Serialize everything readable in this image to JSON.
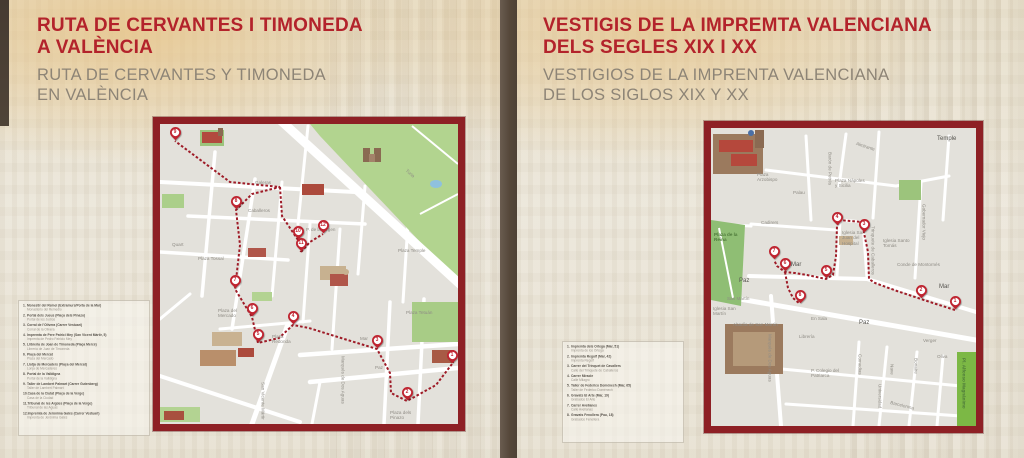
{
  "colors": {
    "title_red": "#b3232b",
    "subtitle_gray": "#8d8476",
    "map_border_red": "#8e2025",
    "route_red": "#9e1b27",
    "pin_red": "#bf2430",
    "divider_brown": "#544739",
    "background_beige": "#e7e1d2"
  },
  "left_panel": {
    "title_line1": "RUTA DE CERVANTES I TIMONEDA",
    "title_line2": "A VALÈNCIA",
    "subtitle_line1": "RUTA DE CERVANTES Y TIMONEDA",
    "subtitle_line2": "EN VALÈNCIA",
    "legend": [
      {
        "n": "1.",
        "ca": "Monestir del Remei (Extramurs/Porta de la Mar)",
        "es": "Monasterio del Remedio"
      },
      {
        "n": "2.",
        "ca": "Portal dels Jueus (Plaça dels Pinazo)",
        "es": "Portal de los Judíos"
      },
      {
        "n": "3.",
        "ca": "Corral de l'Olivera (Carrer Vestuari)",
        "es": "Corral de la Olivera"
      },
      {
        "n": "4.",
        "ca": "Impremta de Pere Patrici Mey (San Vicent Màrtir, 5)",
        "es": "Imprenta de Pedro Patricio Mey"
      },
      {
        "n": "5.",
        "ca": "Llibreria de Joan de Timoneda (Plaça Mercé)",
        "es": "Librería de Juan de Timoneda"
      },
      {
        "n": "6.",
        "ca": "Plaça del Mercat",
        "es": "Plaza del Mercado"
      },
      {
        "n": "7.",
        "ca": "Llotja de Mercaders (Plaça del Mercat)",
        "es": "Lonja de Mercaderes"
      },
      {
        "n": "8.",
        "ca": "Portal de la Valldigna",
        "es": "Portal de la Valldigna"
      },
      {
        "n": "9.",
        "ca": "Taller de Lambert Palmart (Carrer Gutenberg)",
        "es": "Taller de Lambert Palmart"
      },
      {
        "n": "10.",
        "ca": "Casa de la Ciutat (Plaça de la Verge)",
        "es": "Casa de la Ciudad"
      },
      {
        "n": "11.",
        "ca": "Tribunal de les Aigües (Plaça de la Verge)",
        "es": "Tribunal de las Aguas"
      },
      {
        "n": "12.",
        "ca": "Impremta de Jerònima Galés (Carrer Vestuari)",
        "es": "Imprenta de Jerónima Galés"
      }
    ],
    "map": {
      "pins": [
        {
          "n": "1",
          "x": 292,
          "y": 240
        },
        {
          "n": "2",
          "x": 247,
          "y": 277
        },
        {
          "n": "3",
          "x": 217,
          "y": 225
        },
        {
          "n": "4",
          "x": 133,
          "y": 201
        },
        {
          "n": "5",
          "x": 98,
          "y": 219
        },
        {
          "n": "6",
          "x": 92,
          "y": 193
        },
        {
          "n": "7",
          "x": 75,
          "y": 165
        },
        {
          "n": "8",
          "x": 76,
          "y": 86
        },
        {
          "n": "9",
          "x": 15,
          "y": 17
        },
        {
          "n": "10",
          "x": 138,
          "y": 116
        },
        {
          "n": "11",
          "x": 141,
          "y": 128
        },
        {
          "n": "12",
          "x": 163,
          "y": 110
        }
      ],
      "labels": [
        {
          "t": "Galeras",
          "x": 95,
          "y": 56
        },
        {
          "t": "Caballeros",
          "x": 88,
          "y": 84
        },
        {
          "t": "Quart",
          "x": 12,
          "y": 118
        },
        {
          "t": "Plaza Tossal",
          "x": 38,
          "y": 132,
          "cls": "wrap"
        },
        {
          "t": "Plaza del Mercado",
          "x": 58,
          "y": 184,
          "cls": "wrap"
        },
        {
          "t": "Plaza Redonda",
          "x": 112,
          "y": 210,
          "cls": "wrap"
        },
        {
          "t": "P. de la Virgen",
          "x": 146,
          "y": 103
        },
        {
          "t": "Mar",
          "x": 200,
          "y": 212
        },
        {
          "t": "Paz",
          "x": 215,
          "y": 241
        },
        {
          "t": "Plaza Tetuán",
          "x": 246,
          "y": 186,
          "cls": "wrap"
        },
        {
          "t": "Plaza Temple",
          "x": 238,
          "y": 124,
          "cls": "wrap"
        },
        {
          "t": "San Vicente Mártir",
          "x": 100,
          "y": 258,
          "cls": "vert"
        },
        {
          "t": "Marqués de Dos Aguas",
          "x": 180,
          "y": 232,
          "cls": "vert"
        },
        {
          "t": "Turia",
          "x": 248,
          "y": 44,
          "rot": 42
        },
        {
          "t": "Plaza dels Pinazo",
          "x": 230,
          "y": 286,
          "cls": "wrap"
        }
      ]
    }
  },
  "right_panel": {
    "title_line1": "VESTIGIS DE LA IMPREMTA VALENCIANA",
    "title_line2": "DELS SEGLES XIX I XX",
    "subtitle_line1": "VESTIGIOS DE LA IMPRENTA VALENCIANA",
    "subtitle_line2": "DE LOS SIGLOS XIX Y XX",
    "legend": [
      {
        "n": "1.",
        "ca": "Impremta dels Ortega (Mar, 51)",
        "es": "Imprenta de los Ortega"
      },
      {
        "n": "2.",
        "ca": "Impremta Regolf (Mar, 42)",
        "es": "Imprenta Regolf"
      },
      {
        "n": "3.",
        "ca": "Carrer del Trinquet de Cavallers",
        "es": "Calle del Trinquete de Caballeros"
      },
      {
        "n": "4.",
        "ca": "Carrer Miracle",
        "es": "Calle Milagro"
      },
      {
        "n": "5.",
        "ca": "Taller de Federico Doménech (Mar, 65)",
        "es": "Taller de Federico Doménech"
      },
      {
        "n": "6.",
        "ca": "Gravats El Arte (Mar, 19)",
        "es": "Grabados El Arte"
      },
      {
        "n": "7.",
        "ca": "Carrer Avellanes",
        "es": "Calle Avellanas"
      },
      {
        "n": "8.",
        "ca": "Gravats Fenollera (Pau, 18)",
        "es": "Grabados Fenollera"
      }
    ],
    "map": {
      "pins": [
        {
          "n": "1",
          "x": 244,
          "y": 182
        },
        {
          "n": "2",
          "x": 210,
          "y": 171
        },
        {
          "n": "3",
          "x": 153,
          "y": 105
        },
        {
          "n": "4",
          "x": 126,
          "y": 98
        },
        {
          "n": "5",
          "x": 115,
          "y": 151
        },
        {
          "n": "6",
          "x": 74,
          "y": 144
        },
        {
          "n": "7",
          "x": 63,
          "y": 132
        },
        {
          "n": "8",
          "x": 89,
          "y": 176
        }
      ],
      "labels": [
        {
          "t": "Temple",
          "x": 226,
          "y": 8,
          "cls": "lg"
        },
        {
          "t": "Plaza Arzobispo",
          "x": 46,
          "y": 44,
          "cls": "wrap"
        },
        {
          "t": "Palau",
          "x": 82,
          "y": 62
        },
        {
          "t": "Plaza Nápoles y Sicilia",
          "x": 124,
          "y": 50,
          "cls": "wrap"
        },
        {
          "t": "Almirante",
          "x": 146,
          "y": 13,
          "rot": 18
        },
        {
          "t": "Barón de Petrés",
          "x": 116,
          "y": 24,
          "cls": "vert"
        },
        {
          "t": "Gobernador Viejo",
          "x": 210,
          "y": 76,
          "cls": "vert"
        },
        {
          "t": "Cadirers",
          "x": 50,
          "y": 92
        },
        {
          "t": "Plaza de la Reina",
          "x": 3,
          "y": 104,
          "cls": "wrap plaza"
        },
        {
          "t": "Iglesia San Juan del Hospital",
          "x": 131,
          "y": 102,
          "cls": "wrap"
        },
        {
          "t": "Iglesia Santo Tomás",
          "x": 172,
          "y": 110,
          "cls": "wrap"
        },
        {
          "t": "Trinquete de Caballeros",
          "x": 159,
          "y": 98,
          "cls": "vert"
        },
        {
          "t": "Conde de Montornés",
          "x": 186,
          "y": 134
        },
        {
          "t": "Mar",
          "x": 80,
          "y": 134,
          "cls": "lg"
        },
        {
          "t": "Mar",
          "x": 228,
          "y": 156,
          "cls": "lg"
        },
        {
          "t": "Paz",
          "x": 28,
          "y": 150,
          "cls": "lg"
        },
        {
          "t": "Paz",
          "x": 148,
          "y": 192,
          "cls": "lg"
        },
        {
          "t": "San Martín",
          "x": 16,
          "y": 168
        },
        {
          "t": "Iglesia San Martín",
          "x": 2,
          "y": 178,
          "cls": "wrap"
        },
        {
          "t": "Abadía de San Martín",
          "x": 22,
          "y": 194
        },
        {
          "t": "Marqués de Dos Aguas",
          "x": 56,
          "y": 206,
          "cls": "vert"
        },
        {
          "t": "Librería",
          "x": 88,
          "y": 206
        },
        {
          "t": "En Sala",
          "x": 100,
          "y": 188
        },
        {
          "t": "Comedias",
          "x": 146,
          "y": 226,
          "cls": "vert"
        },
        {
          "t": "Universidad",
          "x": 166,
          "y": 256,
          "cls": "vert"
        },
        {
          "t": "Nave",
          "x": 178,
          "y": 236,
          "cls": "vert"
        },
        {
          "t": "Bonaire",
          "x": 202,
          "y": 230,
          "cls": "vert"
        },
        {
          "t": "Oliva",
          "x": 226,
          "y": 226
        },
        {
          "t": "Verger",
          "x": 212,
          "y": 210
        },
        {
          "t": "Barcelonina",
          "x": 180,
          "y": 272,
          "rot": 14
        },
        {
          "t": "P. Colegio del Patriarca",
          "x": 100,
          "y": 240,
          "cls": "wrap"
        },
        {
          "t": "Pl. Alfonso Magnánimo",
          "x": 250,
          "y": 230,
          "cls": "vert plaza"
        }
      ]
    }
  }
}
